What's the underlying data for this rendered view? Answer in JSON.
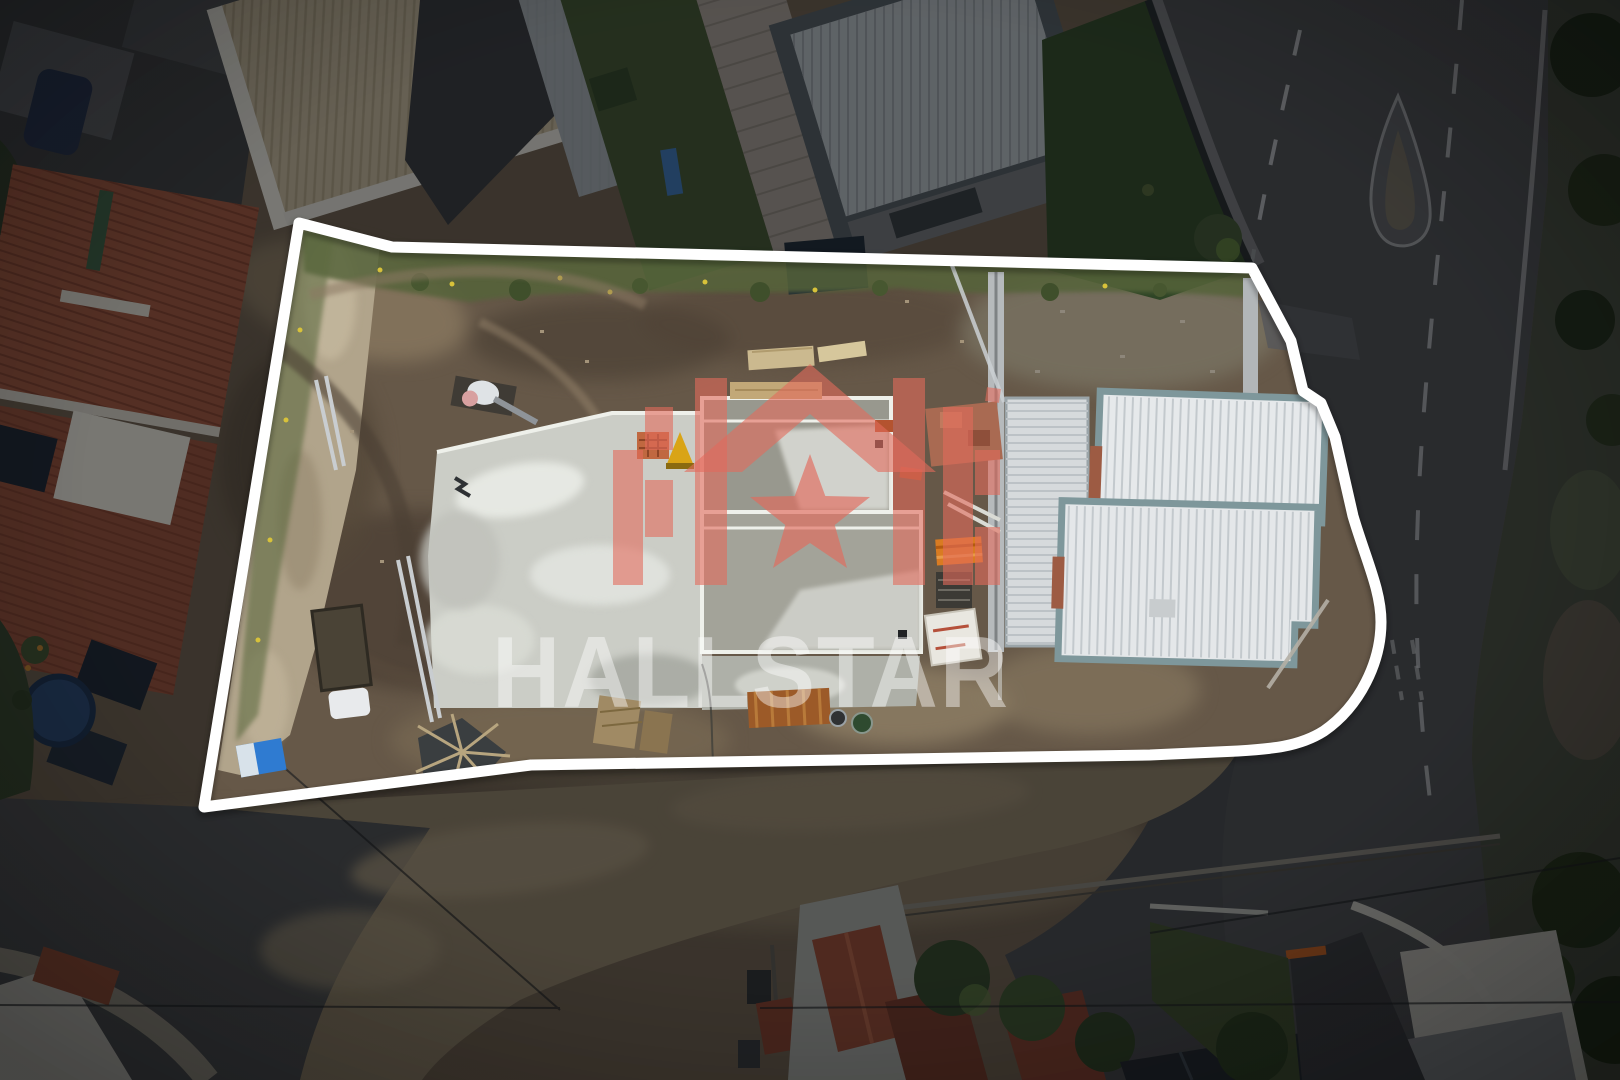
{
  "image": {
    "kind": "aerial-drone-photo",
    "subject": "construction site parcel outlined in white among houses and roads"
  },
  "watermark": {
    "text": "HALLSTAR",
    "logo_icon": "house-star-logo-icon"
  },
  "palette": {
    "boundary_color": "#ffffff",
    "logo_color": "#e26a5c",
    "watermark_text_color": "#ffffff",
    "watermark_opacity": "0.44"
  }
}
